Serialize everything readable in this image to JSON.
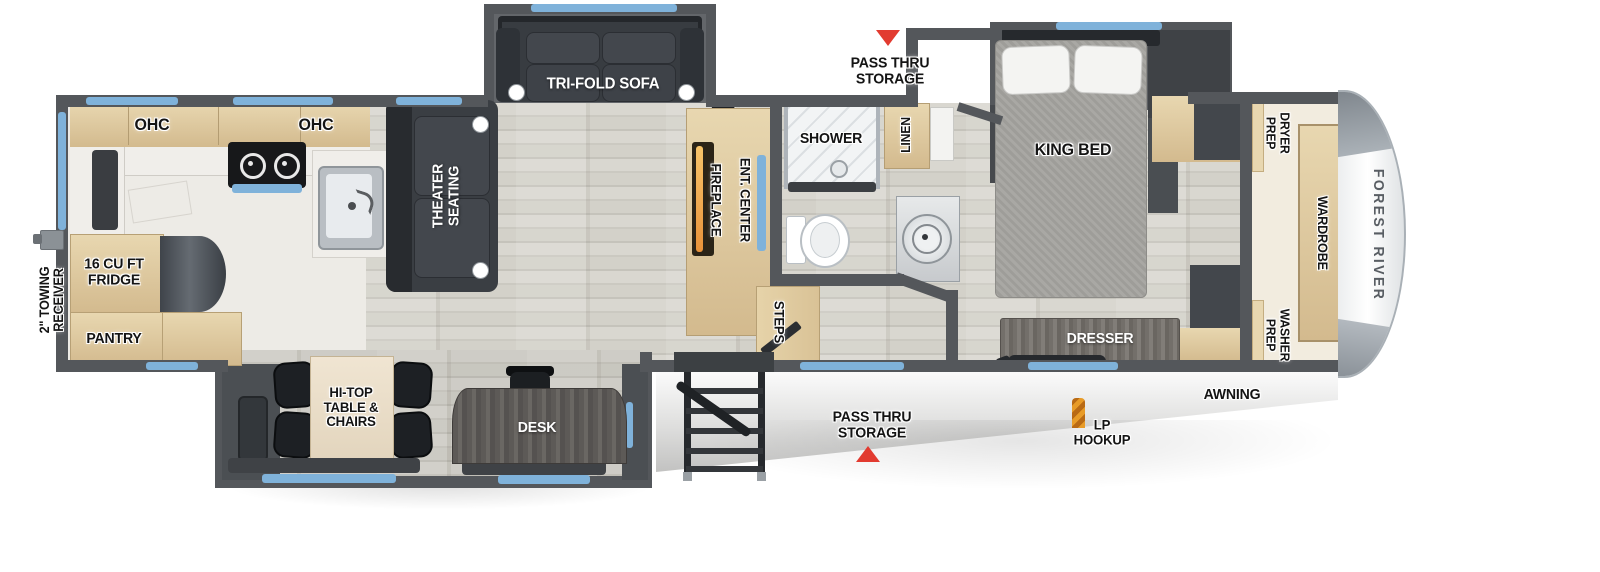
{
  "labels": {
    "ohc": "OHC",
    "fridge": "16 CU FT\nFRIDGE",
    "pantry": "PANTRY",
    "towing_receiver": "2\" TOWING\nRECEIVER",
    "theater_seating": "THEATER\nSEATING",
    "tri_fold_sofa": "TRI-FOLD SOFA",
    "fireplace": "FIREPLACE",
    "ent_center": "ENT. CENTER",
    "shower": "SHOWER",
    "linen": "LINEN",
    "pass_thru_storage_top": "PASS THRU\nSTORAGE",
    "king_bed": "KING BED",
    "steps": "STEPS",
    "dresser": "DRESSER",
    "dryer_prep": "DRYER\nPREP",
    "washer_prep": "WASHER\nPREP",
    "wardrobe": "WARDROBE",
    "brand": "FOREST RIVER",
    "awning": "AWNING",
    "lp_hookup": "LP\nHOOKUP",
    "pass_thru_storage_bottom": "PASS THRU\nSTORAGE",
    "hi_top_table": "HI-TOP\nTABLE &\nCHAIRS",
    "desk": "DESK"
  },
  "colors": {
    "wall": "#54575b",
    "window": "#7fb2da",
    "red": "#e23b30",
    "tan": "#d3ba8e",
    "tan_light": "#e8d7b0",
    "dark_furniture": "#34383d",
    "kitchen_floor": "#edebe6",
    "mattress": "#a6a5a1",
    "cap_trim": "#8b9298",
    "orange": "#e89b27",
    "label": "#141414",
    "label_white": "#ffffff"
  }
}
